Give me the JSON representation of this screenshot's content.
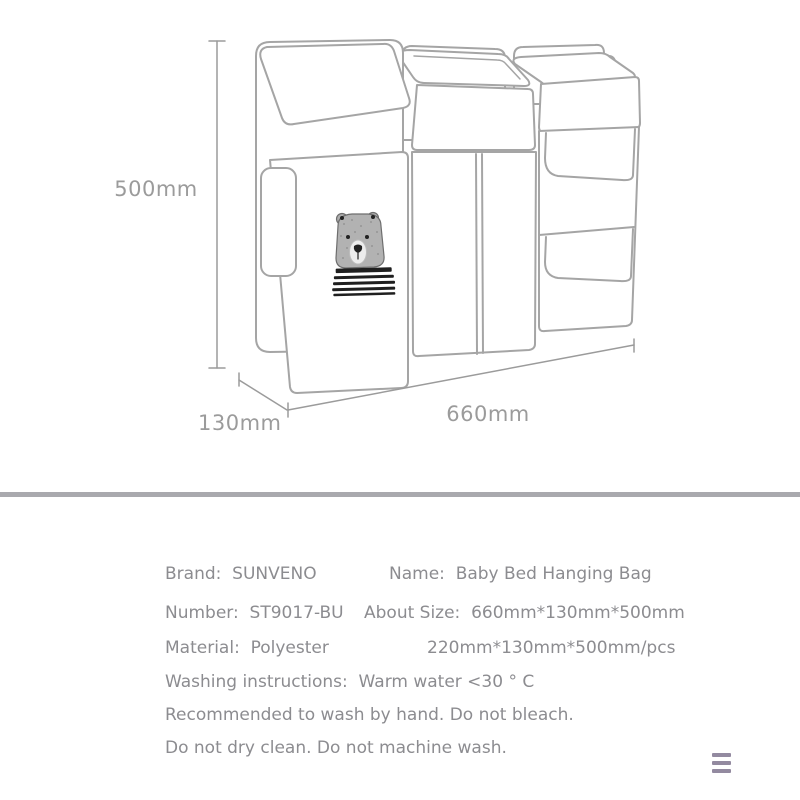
{
  "drawing": {
    "type": "product-line-drawing",
    "subject": "three-compartment hanging storage bag with bear print",
    "height_label": "500mm",
    "depth_label": "130mm",
    "width_label": "660mm"
  },
  "specs": {
    "brand": "Brand:  SUNVENO",
    "name": "Name:  Baby Bed Hanging Bag",
    "number": "Number:  ST9017-BU",
    "about_size": "About Size:  660mm*130mm*500mm",
    "material": "Material:  Polyester",
    "size_per_piece": "220mm*130mm*500mm/pcs",
    "washing_instructions": "Washing instructions:  Warm water <30 ° C",
    "care_line_1": "Recommended to wash by hand. Do not bleach.",
    "care_line_2": "Do not dry clean. Do not machine wash."
  },
  "icons": {
    "menu": "hamburger-menu"
  },
  "colors": {
    "spec_text": "#8c8c90",
    "dimension_text": "#9b9b9b",
    "line_art": "#a5a5a5",
    "divider": "#a9a9ae",
    "menu_icon": "#938aa0"
  }
}
